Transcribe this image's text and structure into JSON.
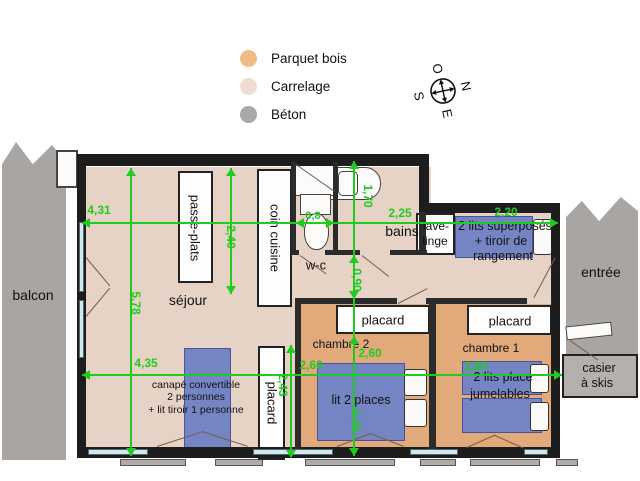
{
  "legend": {
    "items": [
      {
        "label": "Parquet bois",
        "color": "#f0bc85"
      },
      {
        "label": "Carrelage",
        "color": "#efdcd2"
      },
      {
        "label": "Béton",
        "color": "#a8a8a8"
      }
    ]
  },
  "compass": {
    "n": "N",
    "s": "S",
    "e": "E",
    "o": "O"
  },
  "colors": {
    "carrelage": "#e7d3c5",
    "parquet": "#e2a97b",
    "beton": "#a8a5a2",
    "bed_blue": "#7585c4",
    "dimension_green": "#1ecb1e",
    "wall": "#1d1d1d"
  },
  "plan": {
    "texts": [
      {
        "name": "label-balcon",
        "text": "balcon",
        "x": 33,
        "y": 295,
        "fs": 14
      },
      {
        "name": "label-sejour",
        "text": "séjour",
        "x": 188,
        "y": 300,
        "fs": 14
      },
      {
        "name": "label-passe-plats",
        "text": "passe-plats",
        "x": 195,
        "y": 228,
        "fs": 13,
        "rot": 1
      },
      {
        "name": "label-coin-cuisine",
        "text": "coin cuisine",
        "x": 275,
        "y": 238,
        "fs": 13,
        "rot": 1
      },
      {
        "name": "label-placard-sejour",
        "text": "placard",
        "x": 272,
        "y": 403,
        "fs": 13,
        "rot": 1
      },
      {
        "name": "label-wc",
        "text": "w-c",
        "x": 316,
        "y": 265,
        "fs": 13
      },
      {
        "name": "label-bains",
        "text": "bains",
        "x": 402,
        "y": 231,
        "fs": 14
      },
      {
        "name": "label-lave-linge-1",
        "text": "lave-",
        "x": 436,
        "y": 226,
        "fs": 12
      },
      {
        "name": "label-lave-linge-2",
        "text": "linge",
        "x": 435,
        "y": 241,
        "fs": 12
      },
      {
        "name": "label-lits-superposes-1",
        "text": "2 lits superposés",
        "x": 505,
        "y": 226,
        "fs": 12.5
      },
      {
        "name": "label-lits-superposes-2",
        "text": "+ tiroir de",
        "x": 501,
        "y": 241,
        "fs": 12.5
      },
      {
        "name": "label-lits-superposes-3",
        "text": "rangement",
        "x": 503,
        "y": 256,
        "fs": 12.5
      },
      {
        "name": "label-entree",
        "text": "entrée",
        "x": 601,
        "y": 272,
        "fs": 14
      },
      {
        "name": "label-placard-ch2",
        "text": "placard",
        "x": 383,
        "y": 320,
        "fs": 13
      },
      {
        "name": "label-placard-ch1",
        "text": "placard",
        "x": 510,
        "y": 321,
        "fs": 13
      },
      {
        "name": "label-chambre-2",
        "text": "chambre 2",
        "x": 341,
        "y": 344,
        "fs": 12
      },
      {
        "name": "label-chambre-1",
        "text": "chambre 1",
        "x": 491,
        "y": 348,
        "fs": 12
      },
      {
        "name": "label-casier-1",
        "text": "casier",
        "x": 599,
        "y": 368,
        "fs": 12.5
      },
      {
        "name": "label-casier-2",
        "text": "à skis",
        "x": 597,
        "y": 383,
        "fs": 12.5
      },
      {
        "name": "label-canape-1",
        "text": "canapé convertible",
        "x": 196,
        "y": 385,
        "fs": 10.5
      },
      {
        "name": "label-canape-2",
        "text": "2 personnes",
        "x": 196,
        "y": 397,
        "fs": 10.5
      },
      {
        "name": "label-canape-3",
        "text": "+ lit tiroir 1 personne",
        "x": 196,
        "y": 410,
        "fs": 10.5
      },
      {
        "name": "label-lit-2-places",
        "text": "lit 2 places",
        "x": 361,
        "y": 400,
        "fs": 12.5
      },
      {
        "name": "label-lits-jumelables-1",
        "text": "2 lits place",
        "x": 503,
        "y": 377,
        "fs": 12.5
      },
      {
        "name": "label-lits-jumelables-2",
        "text": "jumelables",
        "x": 500,
        "y": 394,
        "fs": 12.5
      },
      {
        "name": "dim-4-31",
        "text": "4,31",
        "x": 99,
        "y": 210,
        "fs": 12,
        "cls": "dim"
      },
      {
        "name": "dim-2-25",
        "text": "2,25",
        "x": 400,
        "y": 213,
        "fs": 12,
        "cls": "dim"
      },
      {
        "name": "dim-2-20",
        "text": "2,20",
        "x": 506,
        "y": 212,
        "fs": 12,
        "cls": "dim"
      },
      {
        "name": "dim-0-8",
        "text": "0,8",
        "x": 313,
        "y": 216,
        "fs": 11,
        "cls": "dim"
      },
      {
        "name": "dim-1-70",
        "text": "1,70",
        "x": 368,
        "y": 196,
        "fs": 12,
        "cls": "dim",
        "rot": 1
      },
      {
        "name": "dim-2-40",
        "text": "2,40",
        "x": 231,
        "y": 237,
        "fs": 12,
        "cls": "dim",
        "rot": 1
      },
      {
        "name": "dim-0-90",
        "text": "0,90",
        "x": 357,
        "y": 280,
        "fs": 12,
        "cls": "dim",
        "rot": 1
      },
      {
        "name": "dim-5-78",
        "text": "5,78",
        "x": 136,
        "y": 303,
        "fs": 12,
        "cls": "dim",
        "rot": 1
      },
      {
        "name": "dim-4-35",
        "text": "4,35",
        "x": 146,
        "y": 363,
        "fs": 12,
        "cls": "dim"
      },
      {
        "name": "dim-2-60-a",
        "text": "2,60",
        "x": 311,
        "y": 365,
        "fs": 12,
        "cls": "dim"
      },
      {
        "name": "dim-2-60-b",
        "text": "2,60",
        "x": 370,
        "y": 353,
        "fs": 12,
        "cls": "dim"
      },
      {
        "name": "dim-2-60-c",
        "text": "2,60",
        "x": 476,
        "y": 366,
        "fs": 12,
        "cls": "dim"
      },
      {
        "name": "dim-2-43",
        "text": "2,43",
        "x": 283,
        "y": 385,
        "fs": 12,
        "cls": "dim",
        "rot": 1
      },
      {
        "name": "dim-2-46",
        "text": "2,46",
        "x": 356,
        "y": 420,
        "fs": 12,
        "cls": "dim",
        "rot": 1
      }
    ],
    "lines": [
      {
        "name": "dimline-top",
        "x": 82,
        "y": 222,
        "w": 476,
        "h": 2
      },
      {
        "name": "dimline-bottom",
        "x": 82,
        "y": 374,
        "w": 480,
        "h": 2
      },
      {
        "name": "dimline-5-78",
        "x": 130,
        "y": 168,
        "w": 2,
        "h": 288
      },
      {
        "name": "dimline-2-40",
        "x": 230,
        "y": 168,
        "w": 2,
        "h": 126
      },
      {
        "name": "dimline-middle-vert",
        "x": 353,
        "y": 161,
        "w": 2,
        "h": 295
      },
      {
        "name": "dimline-2-43",
        "x": 290,
        "y": 345,
        "w": 2,
        "h": 112
      }
    ],
    "arrows": [
      {
        "x": 82,
        "y": 218,
        "d": "l"
      },
      {
        "x": 550,
        "y": 218,
        "d": "r"
      },
      {
        "x": 296,
        "y": 218,
        "d": "l"
      },
      {
        "x": 326,
        "y": 218,
        "d": "r"
      },
      {
        "x": 82,
        "y": 370,
        "d": "l"
      },
      {
        "x": 554,
        "y": 370,
        "d": "r"
      },
      {
        "x": 126,
        "y": 168,
        "d": "u"
      },
      {
        "x": 126,
        "y": 448,
        "d": "d"
      },
      {
        "x": 226,
        "y": 168,
        "d": "u"
      },
      {
        "x": 226,
        "y": 286,
        "d": "d"
      },
      {
        "x": 349,
        "y": 161,
        "d": "u"
      },
      {
        "x": 349,
        "y": 255,
        "d": "u"
      },
      {
        "x": 349,
        "y": 291,
        "d": "d"
      },
      {
        "x": 349,
        "y": 336,
        "d": "u"
      },
      {
        "x": 349,
        "y": 448,
        "d": "d"
      },
      {
        "x": 286,
        "y": 345,
        "d": "u"
      },
      {
        "x": 286,
        "y": 450,
        "d": "d"
      }
    ]
  }
}
